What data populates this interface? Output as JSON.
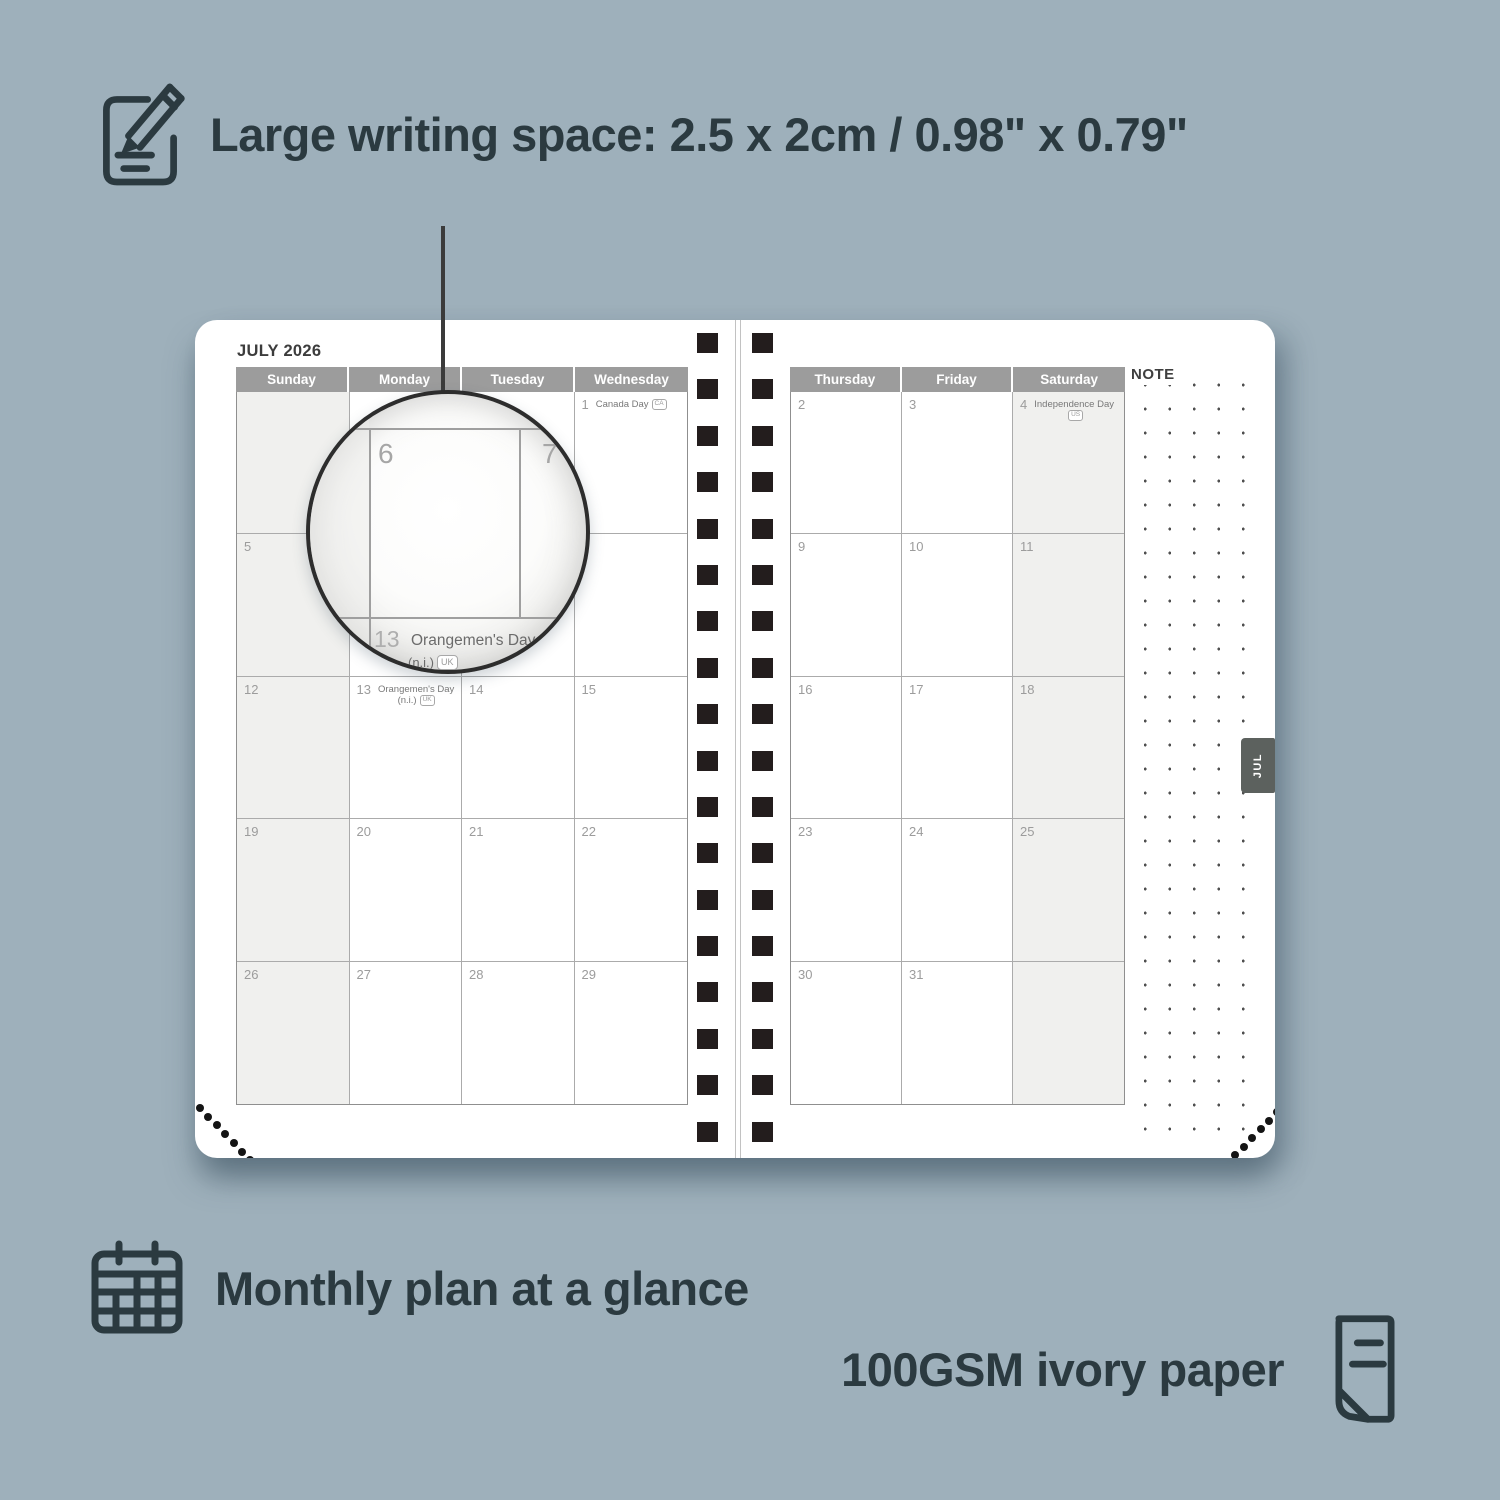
{
  "background_color": "#9eb0bb",
  "accent_text_color": "#2b3a40",
  "features": {
    "top": {
      "label": "Large writing space: 2.5 x 2cm / 0.98\" x 0.79\"",
      "icon": "notepad-pencil-icon"
    },
    "bottom_left": {
      "label": "Monthly plan at a glance",
      "icon": "calendar-grid-icon"
    },
    "bottom_right": {
      "label": "100GSM ivory paper",
      "icon": "paper-sheet-icon"
    }
  },
  "planner": {
    "title": "JULY 2026",
    "tab_label": "JUL",
    "note_label": "NOTE",
    "spiral_hole_color": "#231d1d",
    "header_color": "#9c9c9c",
    "left_page": {
      "day_headers": [
        "Sunday",
        "Monday",
        "Tuesday",
        "Wednesday"
      ],
      "shaded_column": 0,
      "rows": [
        [
          {
            "day": ""
          },
          {
            "day": ""
          },
          {
            "day": ""
          },
          {
            "day": "1",
            "holiday": "Canada Day",
            "badge": "CA",
            "badge_inline": true
          }
        ],
        [
          {
            "day": "5"
          },
          {
            "day": "6"
          },
          {
            "day": "7"
          },
          {
            "day": "8"
          }
        ],
        [
          {
            "day": "12"
          },
          {
            "day": "13",
            "holiday": "Orangemen's Day",
            "line2": "(n.i.)",
            "badge": "UK"
          },
          {
            "day": "14"
          },
          {
            "day": "15"
          }
        ],
        [
          {
            "day": "19"
          },
          {
            "day": "20"
          },
          {
            "day": "21"
          },
          {
            "day": "22"
          }
        ],
        [
          {
            "day": "26"
          },
          {
            "day": "27"
          },
          {
            "day": "28"
          },
          {
            "day": "29"
          }
        ]
      ]
    },
    "right_page": {
      "day_headers": [
        "Thursday",
        "Friday",
        "Saturday"
      ],
      "shaded_column": 2,
      "rows": [
        [
          {
            "day": "2"
          },
          {
            "day": "3"
          },
          {
            "day": "4",
            "holiday": "Independence Day",
            "badge": "US"
          }
        ],
        [
          {
            "day": "9"
          },
          {
            "day": "10"
          },
          {
            "day": "11"
          }
        ],
        [
          {
            "day": "16"
          },
          {
            "day": "17"
          },
          {
            "day": "18"
          }
        ],
        [
          {
            "day": "23"
          },
          {
            "day": "24"
          },
          {
            "day": "25"
          }
        ],
        [
          {
            "day": "30"
          },
          {
            "day": "31"
          },
          {
            "day": ""
          }
        ]
      ]
    }
  },
  "magnifier": {
    "cell_left_day": "6",
    "cell_right_day": "7",
    "bottom_day": "13",
    "bottom_holiday": "Orangemen's Day",
    "bottom_line2": "(n.i.)",
    "bottom_badge": "UK"
  }
}
